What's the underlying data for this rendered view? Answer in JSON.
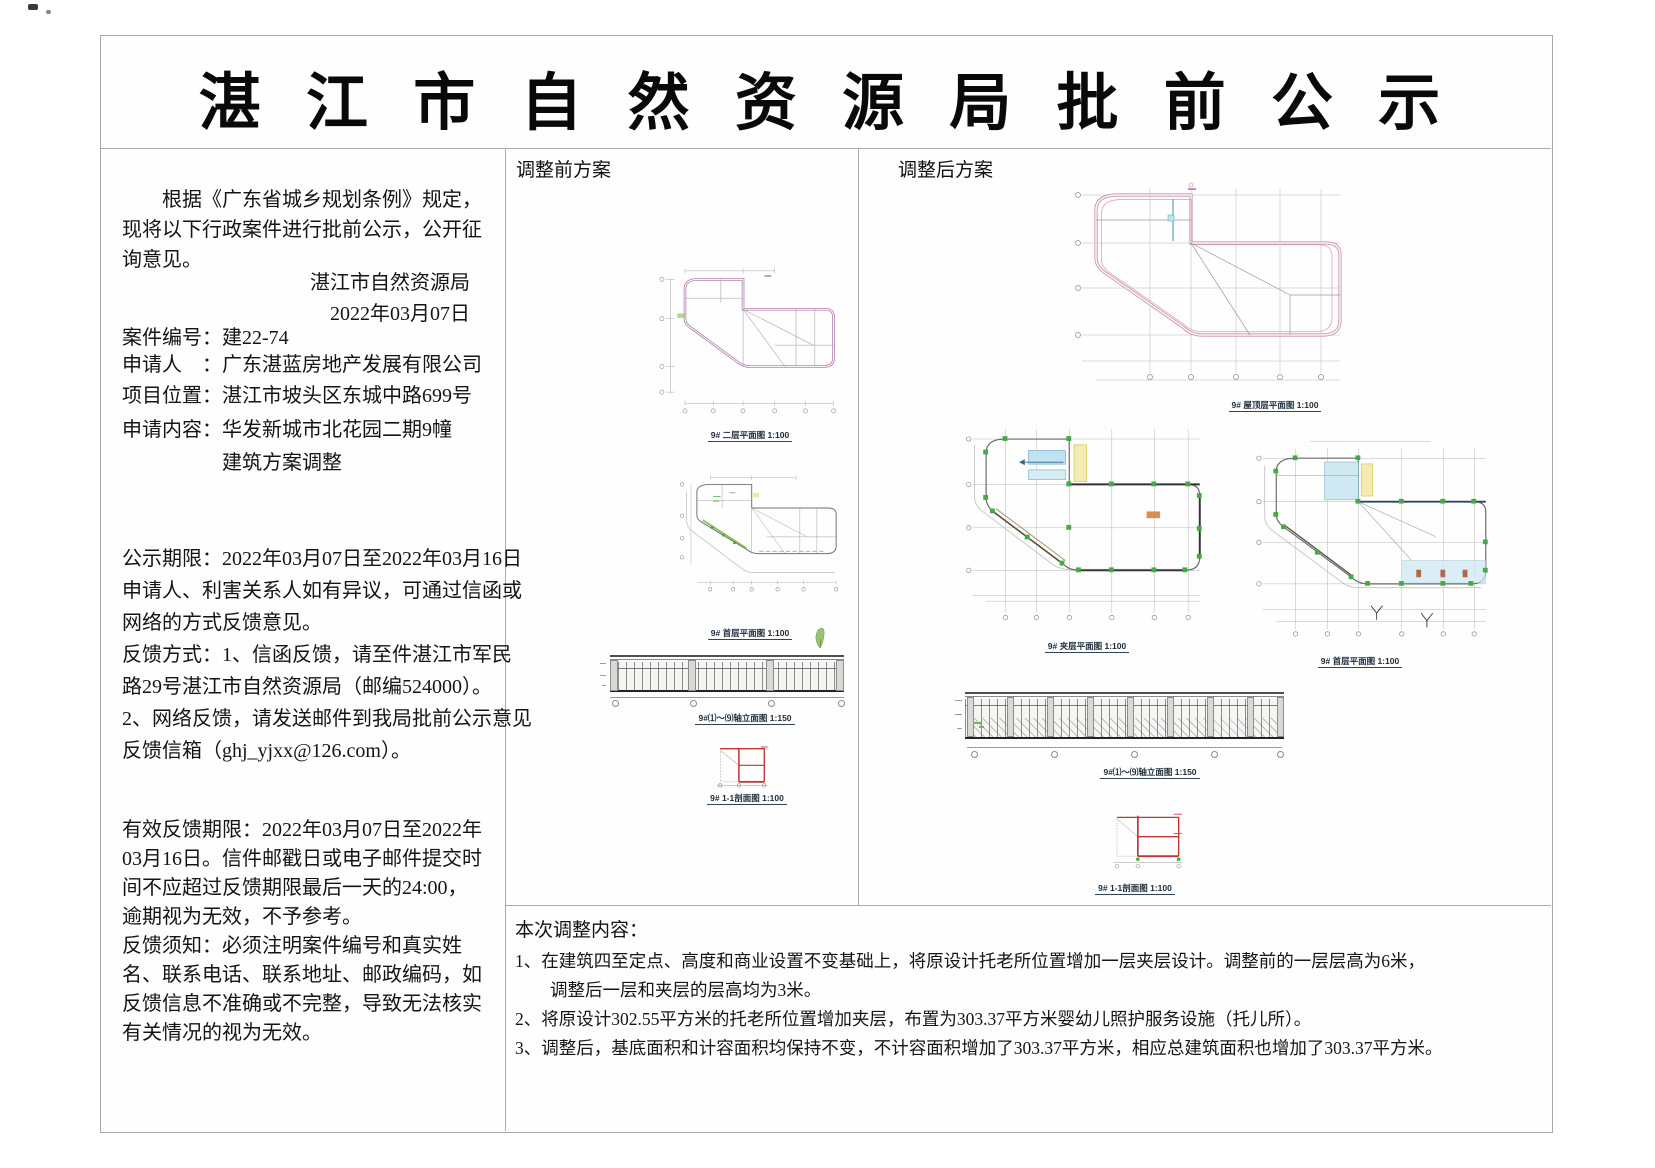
{
  "title": "湛 江 市 自 然 资 源 局 批 前 公 示",
  "left": {
    "intro_lines": [
      "　　根据《广东省城乡规划条例》规定，",
      "现将以下行政案件进行批前公示，公开征",
      "询意见。"
    ],
    "agency": "湛江市自然资源局",
    "date": "2022年03月07日",
    "fields": [
      {
        "text": "案件编号：建22-74"
      },
      {
        "text": "申请人　：广东湛蓝房地产发展有限公司"
      },
      {
        "text": "项目位置：湛江市坡头区东城中路699号"
      },
      {
        "text": "申请内容：华发新城市北花园二期9幢"
      },
      {
        "text": "　　　　　建筑方案调整"
      }
    ],
    "notice_lines": [
      "公示期限：2022年03月07日至2022年03月16日",
      "申请人、利害关系人如有异议，可通过信函或",
      "网络的方式反馈意见。",
      "反馈方式：1、信函反馈，请至件湛江市军民",
      "路29号湛江市自然资源局（邮编524000）。",
      "2、网络反馈，请发送邮件到我局批前公示意见",
      "反馈信箱（ghj_yjxx@126.com）。"
    ],
    "valid_lines": [
      "有效反馈期限：2022年03月07日至2022年",
      "03月16日。信件邮戳日或电子邮件提交时",
      "间不应超过反馈期限最后一天的24:00，",
      "逾期视为无效，不予参考。",
      "反馈须知：必须注明案件编号和真实姓",
      "名、联系电话、联系地址、邮政编码，如",
      "反馈信息不准确或不完整，导致无法核实",
      "有关情况的视为无效。"
    ]
  },
  "panels": {
    "before": {
      "label": "调整前方案",
      "captions": {
        "plan2f": "9# 二层平面图 1:100",
        "plan1f": "9# 首层平面图 1:100",
        "elev": "9#⑴～⑼轴立面图 1:150",
        "section": "9# 1-1剖面图 1:100"
      }
    },
    "after": {
      "label": "调整后方案",
      "captions": {
        "roof": "9# 屋顶层平面图 1:100",
        "mezz": "9# 夹层平面图 1:100",
        "plan1f": "9# 首层平面图 1:100",
        "elev": "9#⑴～⑼轴立面图 1:150",
        "section": "9# 1-1剖面图 1:100"
      }
    }
  },
  "adjustments": {
    "heading": "本次调整内容：",
    "item_lines": [
      "1、在建筑四至定点、高度和商业设置不变基础上，将原设计托老所位置增加一层夹层设计。调整前的一层层高为6米，",
      "　　调整后一层和夹层的层高均为3米。",
      "2、将原设计302.55平方米的托老所位置增加夹层，布置为303.37平方米婴幼儿照护服务设施（托儿所）。",
      "3、调整后，基底面积和计容面积均保持不变，不计容面积增加了303.37平方米，相应总建筑面积也增加了303.37平方米。"
    ]
  },
  "colors": {
    "plan_outline_purple": "#a570a0",
    "plan_outline_pink": "#cf8fae",
    "accent_green": "#44aa44",
    "accent_cyan": "#bfe3f0",
    "accent_yellow": "#f2ecb0",
    "section_red": "#c23434",
    "line_gray": "#8a8a8a"
  }
}
